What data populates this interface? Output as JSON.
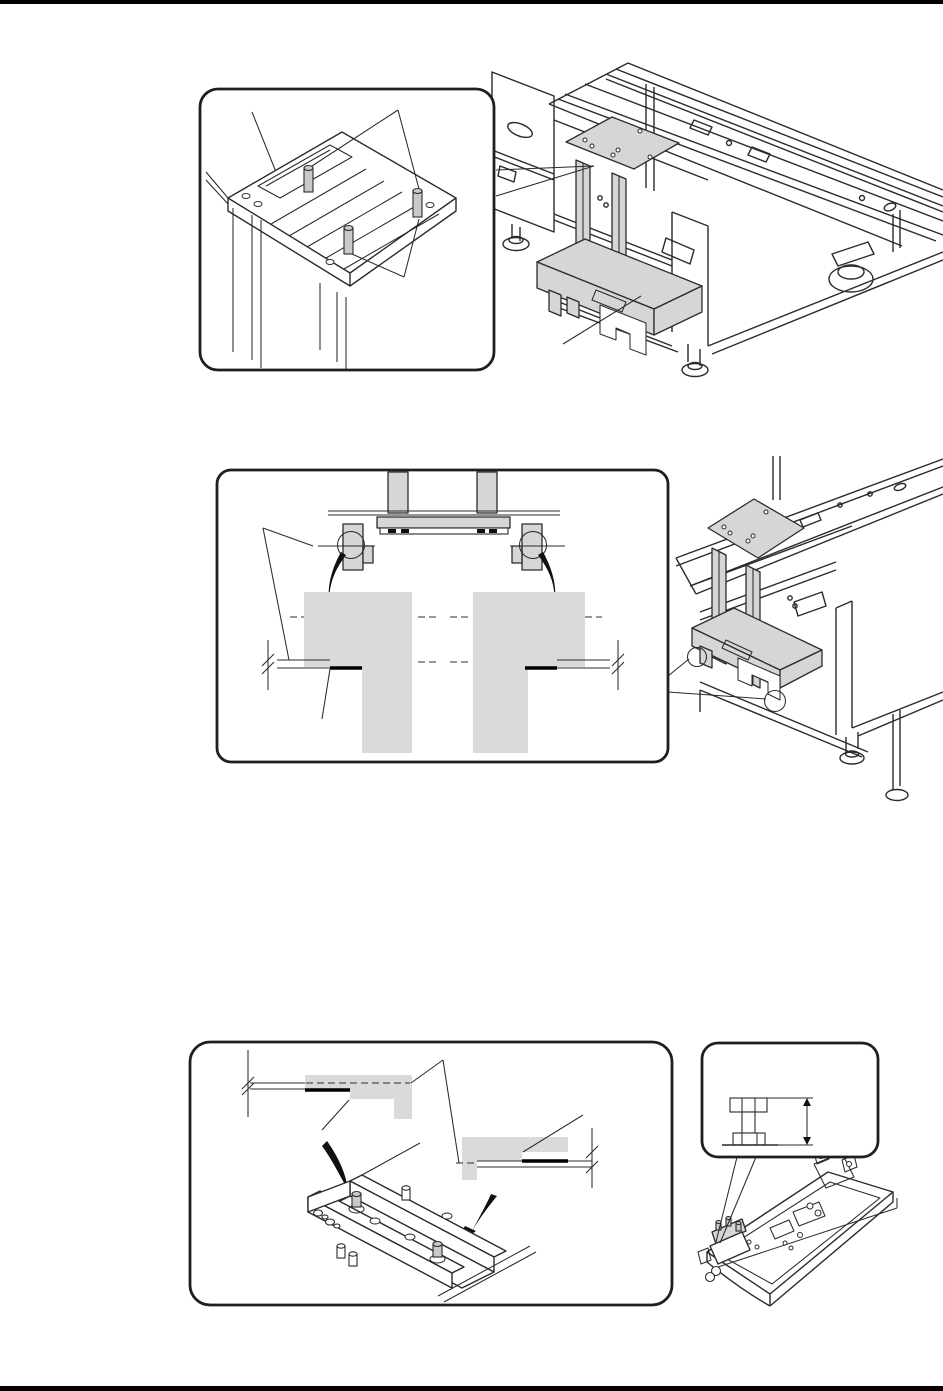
{
  "page": {
    "width_px": 943,
    "height_px": 1391,
    "background": "#ffffff",
    "top_rule_color": "#000000",
    "bottom_rule_color": "#000000"
  },
  "colors": {
    "line": "#2b2b2b",
    "box_stroke": "#1f1f1f",
    "part_fill": "#d6d6d6",
    "block_fill": "#dadada",
    "pin_fill": "#c9c9c9",
    "arrow_fill": "#101010",
    "rule": "#000000"
  },
  "figures": {
    "top": {
      "name": "lift-bracket-installed-on-machine-frame",
      "callout": "mounting-plate-with-locating-pins-isometric"
    },
    "middle": {
      "name": "machine-frame-with-bracket-isometric",
      "callout": "bracket-hooks-engaging-slotted-blocks-front-view",
      "callout_markers": "two-circle-callouts-with-curved-arrows"
    },
    "bottom": {
      "name": "rail-and-plate-engagement-details",
      "callout_left": "stepped-plate-cross-sections-with-curved-arrows-onto-pin-rail",
      "callout_right": "shoulder-pin-height-cross-section",
      "base_drawing": "long-base-plate-isometric"
    }
  }
}
